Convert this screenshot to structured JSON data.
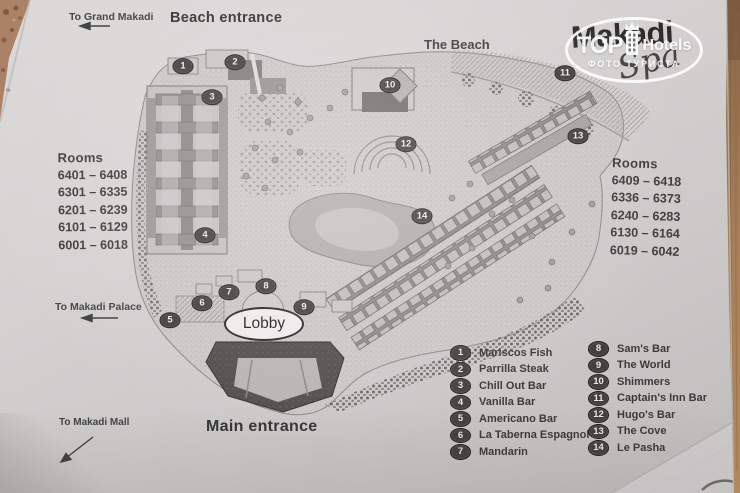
{
  "header": {
    "to_grand_makadi": "To Grand Makadi",
    "beach_entrance": "Beach entrance",
    "the_beach": "The Beach"
  },
  "logo": {
    "title": "Makadi",
    "subtitle": "Spa"
  },
  "watermark": {
    "brand_top": "TOP",
    "brand_rest": "Hotels",
    "tagline": "ФОТО ТУРИСТА",
    "icon": "crown-building-icon"
  },
  "rooms_left": {
    "title": "Rooms",
    "ranges": [
      "6401 – 6408",
      "6301 – 6335",
      "6201 – 6239",
      "6101 – 6129",
      "6001 – 6018"
    ]
  },
  "rooms_right": {
    "title": "Rooms",
    "ranges": [
      "6409 – 6418",
      "6336 – 6373",
      "6240 – 6283",
      "6130 – 6164",
      "6019 – 6042"
    ]
  },
  "map": {
    "lobby_label": "Lobby",
    "main_entrance": "Main entrance",
    "markers": [
      {
        "n": "1",
        "x": 183,
        "y": 66
      },
      {
        "n": "2",
        "x": 235,
        "y": 62
      },
      {
        "n": "3",
        "x": 212,
        "y": 97
      },
      {
        "n": "4",
        "x": 205,
        "y": 235
      },
      {
        "n": "5",
        "x": 170,
        "y": 320
      },
      {
        "n": "6",
        "x": 202,
        "y": 303
      },
      {
        "n": "7",
        "x": 229,
        "y": 292
      },
      {
        "n": "8",
        "x": 266,
        "y": 286
      },
      {
        "n": "9",
        "x": 304,
        "y": 307
      },
      {
        "n": "10",
        "x": 390,
        "y": 85
      },
      {
        "n": "11",
        "x": 565,
        "y": 73
      },
      {
        "n": "12",
        "x": 406,
        "y": 144
      },
      {
        "n": "13",
        "x": 578,
        "y": 136
      },
      {
        "n": "14",
        "x": 422,
        "y": 216
      }
    ]
  },
  "directions": {
    "to_makadi_palace": "To Makadi Palace",
    "to_makadi_mall": "To Makadi Mall"
  },
  "legend": {
    "left": [
      {
        "n": "1",
        "label": "Mariscos Fish"
      },
      {
        "n": "2",
        "label": "Parrilla Steak"
      },
      {
        "n": "3",
        "label": "Chill Out Bar"
      },
      {
        "n": "4",
        "label": "Vanilla Bar"
      },
      {
        "n": "5",
        "label": "Americano Bar"
      },
      {
        "n": "6",
        "label": "La Taberna Espagnol"
      },
      {
        "n": "7",
        "label": "Mandarin"
      }
    ],
    "right": [
      {
        "n": "8",
        "label": "Sam's Bar"
      },
      {
        "n": "9",
        "label": "The World"
      },
      {
        "n": "10",
        "label": "Shimmers"
      },
      {
        "n": "11",
        "label": "Captain's Inn Bar"
      },
      {
        "n": "12",
        "label": "Hugo's Bar"
      },
      {
        "n": "13",
        "label": "The Cove"
      },
      {
        "n": "14",
        "label": "Le Pasha"
      }
    ]
  }
}
